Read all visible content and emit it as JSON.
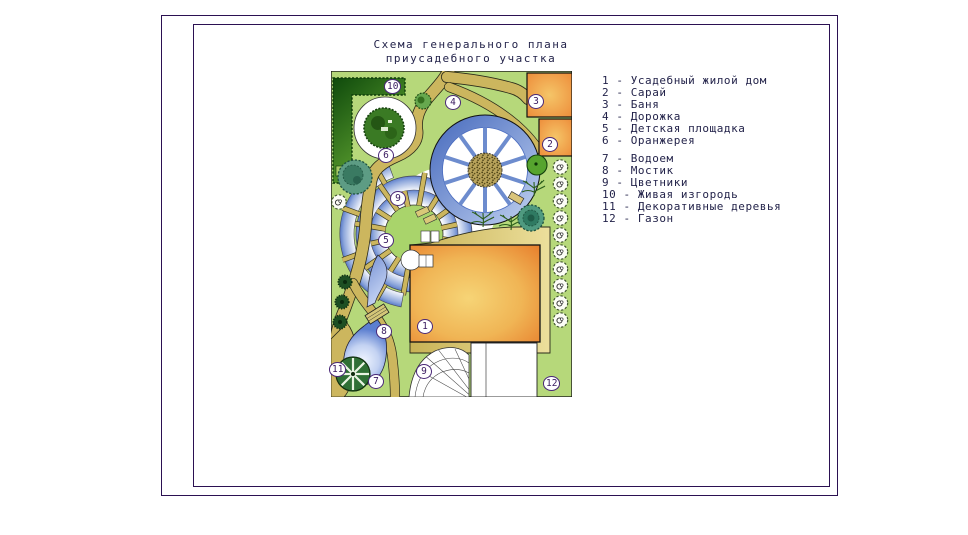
{
  "title": {
    "line1": "Схема генерального плана",
    "line2": "приусадебного участка"
  },
  "legend": {
    "sep": "-",
    "group_break_before": "7",
    "items": [
      {
        "num": "1",
        "label": "Усадебный жилой дом"
      },
      {
        "num": "2",
        "label": "Сарай"
      },
      {
        "num": "3",
        "label": "Баня"
      },
      {
        "num": "4",
        "label": "Дорожка"
      },
      {
        "num": "5",
        "label": "Детская площадка"
      },
      {
        "num": "6",
        "label": "Оранжерея"
      },
      {
        "num": "7",
        "label": "Водоем"
      },
      {
        "num": "8",
        "label": "Мостик"
      },
      {
        "num": "9",
        "label": "Цветники"
      },
      {
        "num": "10",
        "label": "Живая изгородь"
      },
      {
        "num": "11",
        "label": "Декоративные деревья"
      },
      {
        "num": "12",
        "label": "Газон"
      }
    ]
  },
  "plan": {
    "markers": [
      {
        "num": "10",
        "x": 63,
        "y": 15
      },
      {
        "num": "4",
        "x": 122,
        "y": 31
      },
      {
        "num": "3",
        "x": 205,
        "y": 30
      },
      {
        "num": "2",
        "x": 219,
        "y": 73
      },
      {
        "num": "6",
        "x": 55,
        "y": 84
      },
      {
        "num": "9",
        "x": 67,
        "y": 127
      },
      {
        "num": "5",
        "x": 55,
        "y": 169
      },
      {
        "num": "1",
        "x": 94,
        "y": 255
      },
      {
        "num": "8",
        "x": 53,
        "y": 260
      },
      {
        "num": "7",
        "x": 45,
        "y": 310
      },
      {
        "num": "11",
        "x": 8,
        "y": 298
      },
      {
        "num": "9",
        "x": 93,
        "y": 300
      },
      {
        "num": "12",
        "x": 222,
        "y": 312
      }
    ]
  },
  "colors": {
    "lawn": "#b6d87a",
    "path_tan": "#ccb65e",
    "house_edge": "#e8822f",
    "house_center": "#f6d476",
    "water_edge": "#5c7fd0",
    "water_center": "#f0f5ff",
    "hedge_dark": "#0f4a0c",
    "frame_border": "#2b1152",
    "text": "#23234a",
    "marker_text": "#38195f"
  }
}
